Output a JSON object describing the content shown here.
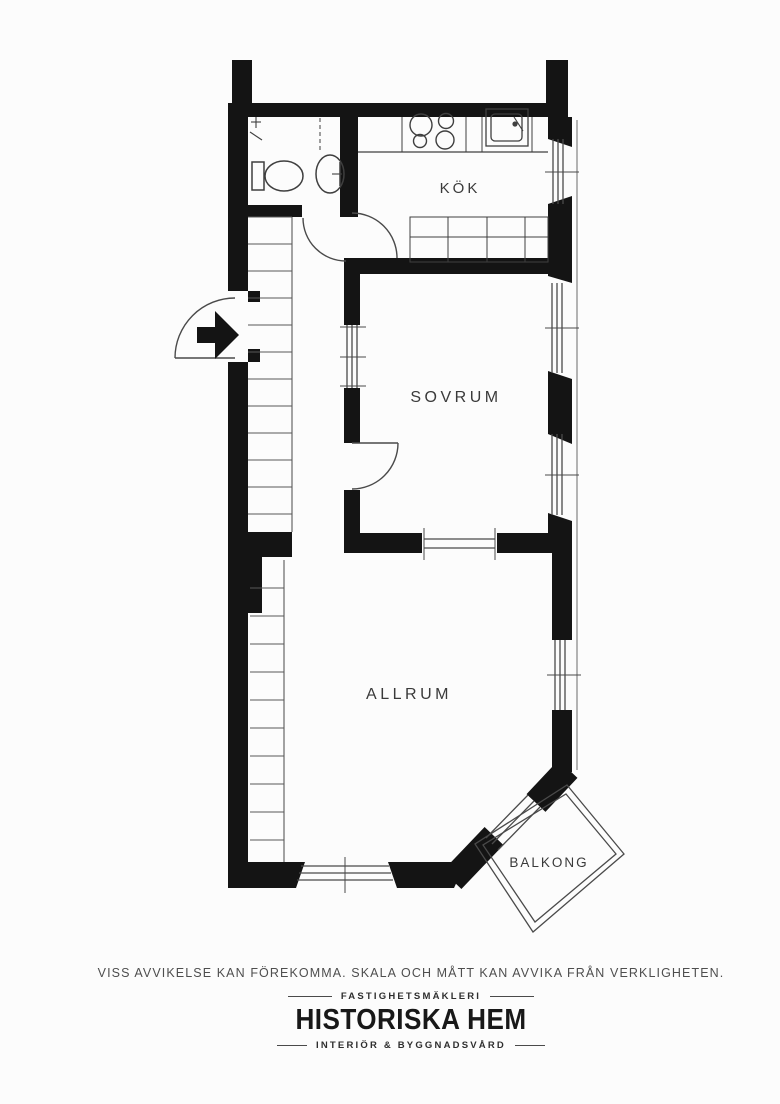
{
  "page": {
    "background": "#fcfcfc"
  },
  "plan": {
    "colors": {
      "wall": "#141414",
      "pencil": "#4a4a4a",
      "label": "#3a3a3a"
    },
    "labels": {
      "kok": "KÖK",
      "sovrum": "SOVRUM",
      "allrum": "ALLRUM",
      "balkong": "BALKONG"
    }
  },
  "footer": {
    "disclaimer": "VISS AVVIKELSE KAN FÖREKOMMA. SKALA OCH MÅTT KAN AVVIKA FRÅN VERKLIGHETEN.",
    "brand": {
      "tagline_top": "FASTIGHETSMÄKLERI",
      "name": "HISTORISKA HEM",
      "tagline_bottom": "INTERIÖR & BYGGNADSVÅRD"
    }
  }
}
